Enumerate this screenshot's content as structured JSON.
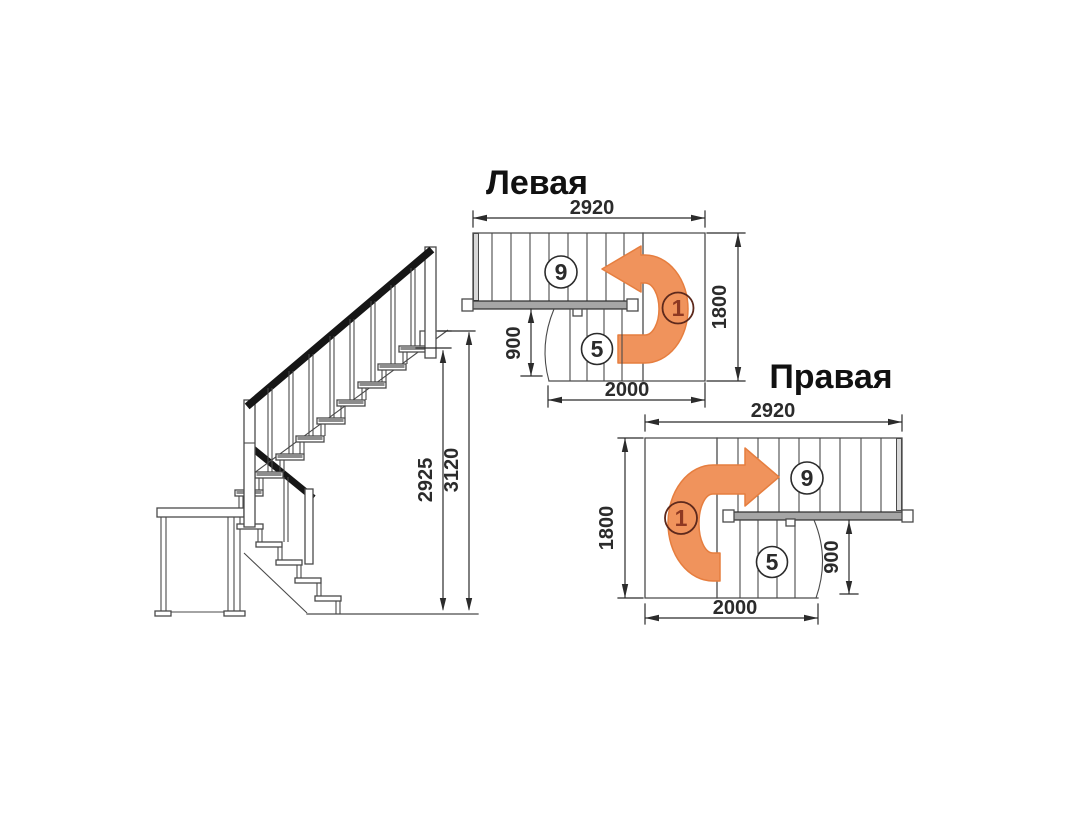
{
  "colors": {
    "line": "#4a4a4a",
    "dark": "#2b2b2b",
    "rail": "#161616",
    "orange": "#f0935c",
    "orange-edge": "#e67e3f",
    "bar": "#a6a6a6",
    "shade": "#d8d8d8",
    "tread": "#8d8d8d",
    "maroon": "#8e3922",
    "circle1": "#5d291c"
  },
  "plan_left": {
    "title": "Левая",
    "dim_width": "2920",
    "dim_depth": "1800",
    "dim_flight_width": "900",
    "dim_lower_length": "2000",
    "count_upper": "9",
    "count_lower": "5",
    "count_start": "1"
  },
  "plan_right": {
    "title": "Правая",
    "dim_width": "2920",
    "dim_depth": "1800",
    "dim_flight_width": "900",
    "dim_lower_length": "2000",
    "count_upper": "9",
    "count_lower": "5",
    "count_start": "1"
  },
  "elevation": {
    "dim_height_to_top_step": "2925",
    "dim_total_height": "3120"
  }
}
